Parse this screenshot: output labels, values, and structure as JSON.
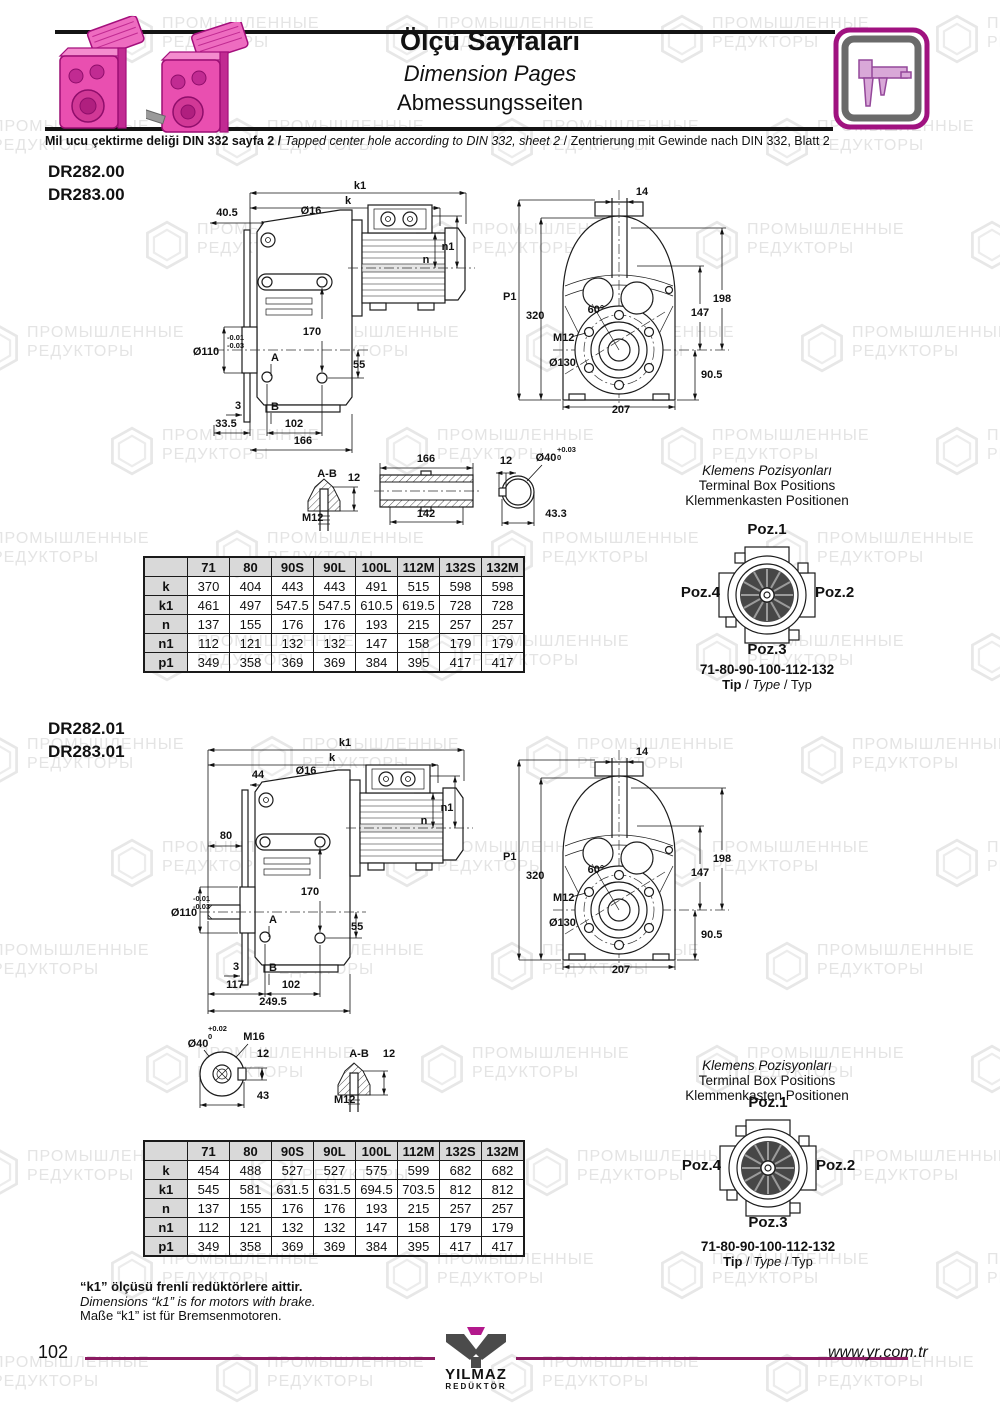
{
  "watermark": {
    "l1": "ПРОМЫШЛЕННЫЕ",
    "l2": "РЕДУКТОРЫ"
  },
  "header": {
    "title_tr": "Ölçü Sayfaları",
    "title_en": "Dimension Pages",
    "title_de": "Abmessungsseiten"
  },
  "note": {
    "tr": "Mil ucu çektirme deliği DIN 332 sayfa 2",
    "sep": "/",
    "en": "Tapped center hole according to DIN 332, sheet 2",
    "de": "Zentrierung mit Gewinde nach DIN 332, Blatt 2"
  },
  "klemens": {
    "title_tr": "Klemens Pozisyonları",
    "title_en": "Terminal Box Positions",
    "title_de": "Klemmenkasten Positionen",
    "poz1": "Poz.1",
    "poz2": "Poz.2",
    "poz3": "Poz.3",
    "poz4": "Poz.4",
    "sizes": "71-80-90-100-112-132",
    "tip": "Tip",
    "sep": "/",
    "type": "Type",
    "typ": "Typ"
  },
  "section1": {
    "model1": "DR282.00",
    "model2": "DR283.00",
    "side": {
      "k1": "k1",
      "k": "k",
      "d405": "40.5",
      "d16": "Ø16",
      "n1": "n1",
      "n": "n",
      "d170": "170",
      "d110": "Ø110",
      "tol1": "-0.01",
      "tol2": "-0.03",
      "A": "A",
      "d55": "55",
      "d3": "3",
      "B": "B",
      "d335": "33.5",
      "d102": "102",
      "d166": "166"
    },
    "front": {
      "d14": "14",
      "P1": "P1",
      "d320": "320",
      "d60": "60°",
      "M12": "M12",
      "d130": "Ø130",
      "d198": "198",
      "d147": "147",
      "d905": "90.5",
      "d207": "207"
    },
    "details": {
      "AB": "A-B",
      "d12a": "12",
      "M12": "M12",
      "d166": "166",
      "d142": "142",
      "d12b": "12",
      "d40": "Ø40",
      "tolp": "+0.03",
      "tol0": "0",
      "d433": "43.3"
    },
    "table": {
      "headers": [
        "",
        "71",
        "80",
        "90S",
        "90L",
        "100L",
        "112M",
        "132S",
        "132M"
      ],
      "rows": [
        {
          "label": "k",
          "values": [
            "370",
            "404",
            "443",
            "443",
            "491",
            "515",
            "598",
            "598"
          ]
        },
        {
          "label": "k1",
          "values": [
            "461",
            "497",
            "547.5",
            "547.5",
            "610.5",
            "619.5",
            "728",
            "728"
          ]
        },
        {
          "label": "n",
          "values": [
            "137",
            "155",
            "176",
            "176",
            "193",
            "215",
            "257",
            "257"
          ]
        },
        {
          "label": "n1",
          "values": [
            "112",
            "121",
            "132",
            "132",
            "147",
            "158",
            "179",
            "179"
          ]
        },
        {
          "label": "p1",
          "values": [
            "349",
            "358",
            "369",
            "369",
            "384",
            "395",
            "417",
            "417"
          ]
        }
      ]
    }
  },
  "section2": {
    "model1": "DR282.01",
    "model2": "DR283.01",
    "side": {
      "k1": "k1",
      "k": "k",
      "d44": "44",
      "d16": "Ø16",
      "n1": "n1",
      "n": "n",
      "d80": "80",
      "d170": "170",
      "d110": "Ø110",
      "tol1": "-0.01",
      "tol2": "-0.03",
      "A": "A",
      "d55": "55",
      "d3": "3",
      "B": "B",
      "d117": "117",
      "d102": "102",
      "d2495": "249.5"
    },
    "front": {
      "d14": "14",
      "P1": "P1",
      "d320": "320",
      "d60": "60°",
      "M12": "M12",
      "d130": "Ø130",
      "d198": "198",
      "d147": "147",
      "d905": "90.5",
      "d207": "207"
    },
    "details": {
      "tolp": "+0.02",
      "tol0": "0",
      "d40": "Ø40",
      "M16": "M16",
      "d12a": "12",
      "d43": "43",
      "AB": "A-B",
      "d12b": "12",
      "M12": "M12"
    },
    "table": {
      "headers": [
        "",
        "71",
        "80",
        "90S",
        "90L",
        "100L",
        "112M",
        "132S",
        "132M"
      ],
      "rows": [
        {
          "label": "k",
          "values": [
            "454",
            "488",
            "527",
            "527",
            "575",
            "599",
            "682",
            "682"
          ]
        },
        {
          "label": "k1",
          "values": [
            "545",
            "581",
            "631.5",
            "631.5",
            "694.5",
            "703.5",
            "812",
            "812"
          ]
        },
        {
          "label": "n",
          "values": [
            "137",
            "155",
            "176",
            "176",
            "193",
            "215",
            "257",
            "257"
          ]
        },
        {
          "label": "n1",
          "values": [
            "112",
            "121",
            "132",
            "132",
            "147",
            "158",
            "179",
            "179"
          ]
        },
        {
          "label": "p1",
          "values": [
            "349",
            "358",
            "369",
            "369",
            "384",
            "395",
            "417",
            "417"
          ]
        }
      ]
    }
  },
  "footnote": {
    "tr": "“k1” ölçüsü frenli redüktörlere aittir.",
    "en": "Dimensions “k1” is for motors with brake.",
    "de": "Maße “k1” ist für Bremsenmotoren."
  },
  "footer": {
    "page": "102",
    "url": "www.yr.com.tr",
    "logo1": "YILMAZ",
    "logo2": "REDÜKTÖR"
  },
  "colors": {
    "accent": "#a01280",
    "footer_line": "#8b1b62",
    "table_gray": "#d9d9d9"
  }
}
